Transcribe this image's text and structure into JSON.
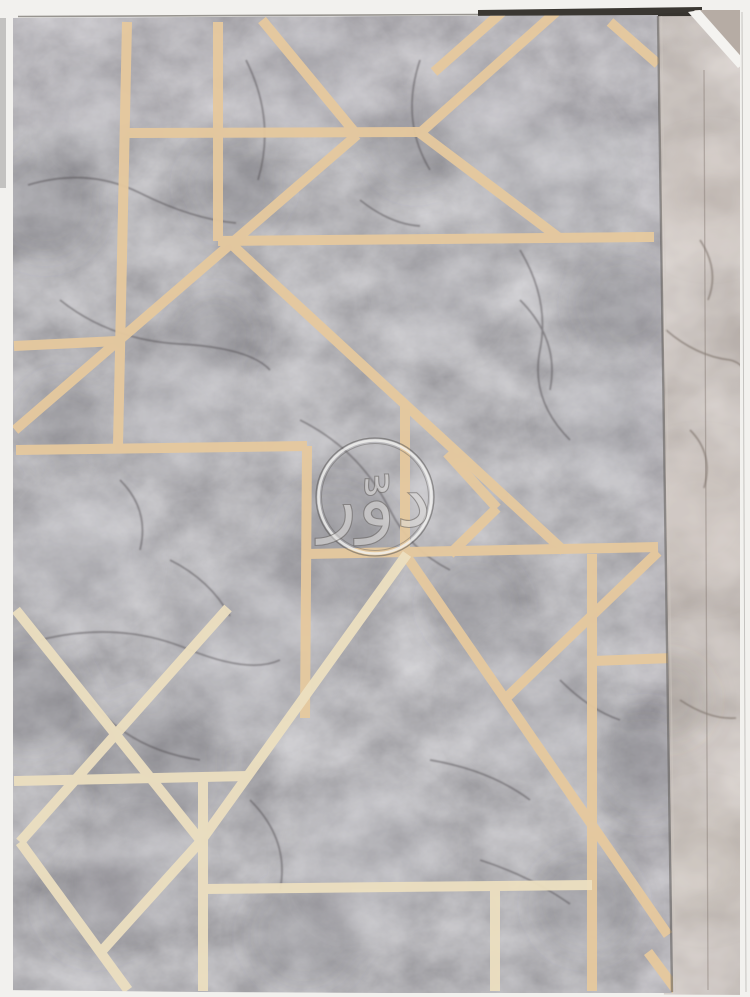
{
  "scene": {
    "type": "photograph",
    "subject": "Wallpaper sample book page",
    "front_sheet": "Grey faux-marble wallpaper with metallic gold geometric art-deco line pattern",
    "back_sheet": "Beige-brown marble wallpaper page partially visible along the right edge",
    "border": "White background visible at top, left, right and bottom edges"
  },
  "watermark": {
    "text": "دوّر",
    "shape": "double-ring-circle",
    "ring_color": "#f3f2f0",
    "ring_edge_color": "#5a5856",
    "text_color": "#dedddb"
  },
  "palette": {
    "border_white": "#f2f1ee",
    "edge_dark": "#2f2c27",
    "edge_line": "#5d5953",
    "edge_shadow": "#57534e",
    "edge_highlight": "#cfc9c2",
    "marble_base": "#8c8b91",
    "marble_light": "#c6c6ca",
    "marble_dark": "#56545b",
    "vein_dark": "#4e4a4e",
    "gold_line": "#e6c99e",
    "gold_line_pale": "#ecdfc0",
    "back_page_base": "#a0968f",
    "back_page_light": "#cfc7c0",
    "back_vein": "#6b5f57",
    "back_seam": "#857a73",
    "corner_flap": "#b6aca4",
    "white_sliver": "#f4f3f0",
    "right_hairline": "#bab8b5",
    "left_shadow": "#c3c2c0"
  }
}
